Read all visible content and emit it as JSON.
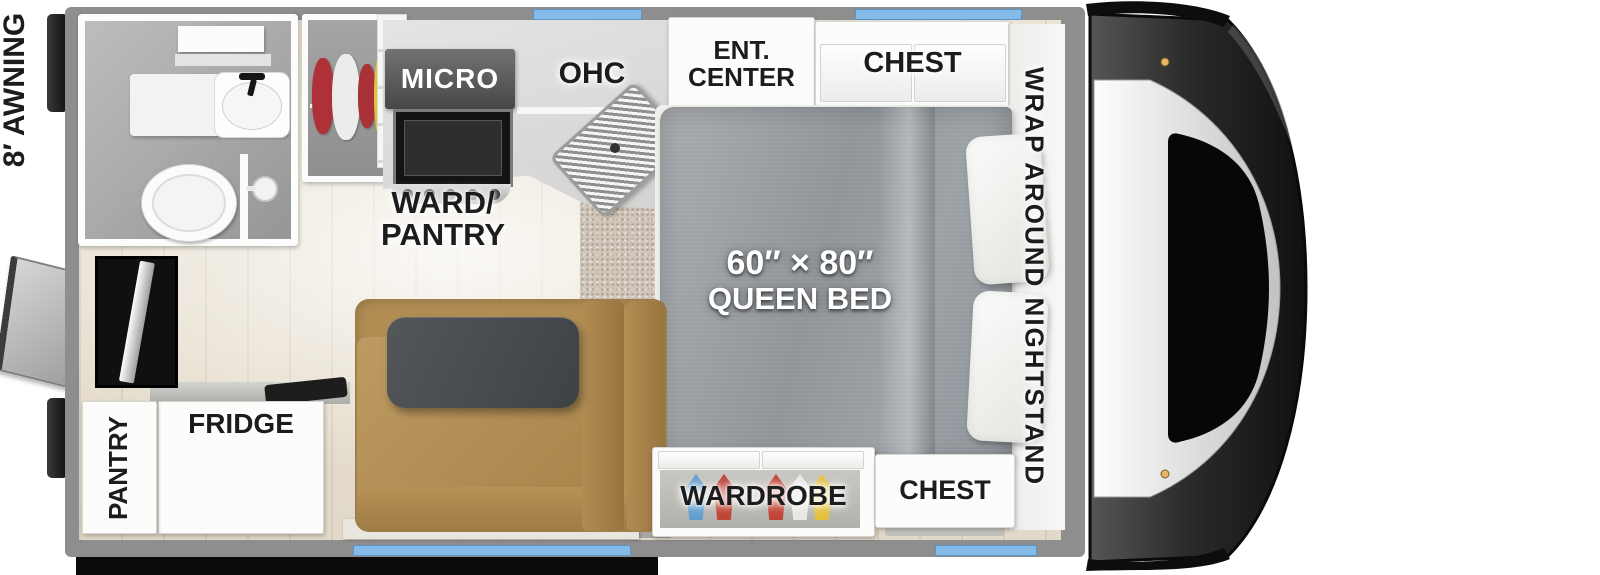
{
  "labels": {
    "awning": "8′ AWNING",
    "micro": "MICRO",
    "ohc": "OHC",
    "ent_line1": "ENT.",
    "ent_line2": "CENTER",
    "chest_top": "CHEST",
    "ward_line1": "WARD/",
    "ward_line2": "PANTRY",
    "bed_size": "60″ × 80″",
    "bed_type": "QUEEN BED",
    "nightstand": "WRAP AROUND NIGHTSTAND",
    "wardrobe": "WARDROBE",
    "chest_bottom": "CHEST",
    "pantry": "PANTRY",
    "fridge": "FRIDGE"
  },
  "colors": {
    "window_blue": "#84bbe8",
    "tv_blue": "#2b50c8",
    "wall_gray": "#8e8e8e",
    "floor_wood": "#e9e1d2",
    "carpet": "#cfc5b8",
    "sofa_tan": "#b08d55",
    "bed_gray": "#9ba0a4",
    "bumper_black": "#0c0c0c",
    "clothes_red": "#b03038",
    "clothes_yellow": "#e6c235",
    "clothes_blue": "#5b9bd0"
  }
}
